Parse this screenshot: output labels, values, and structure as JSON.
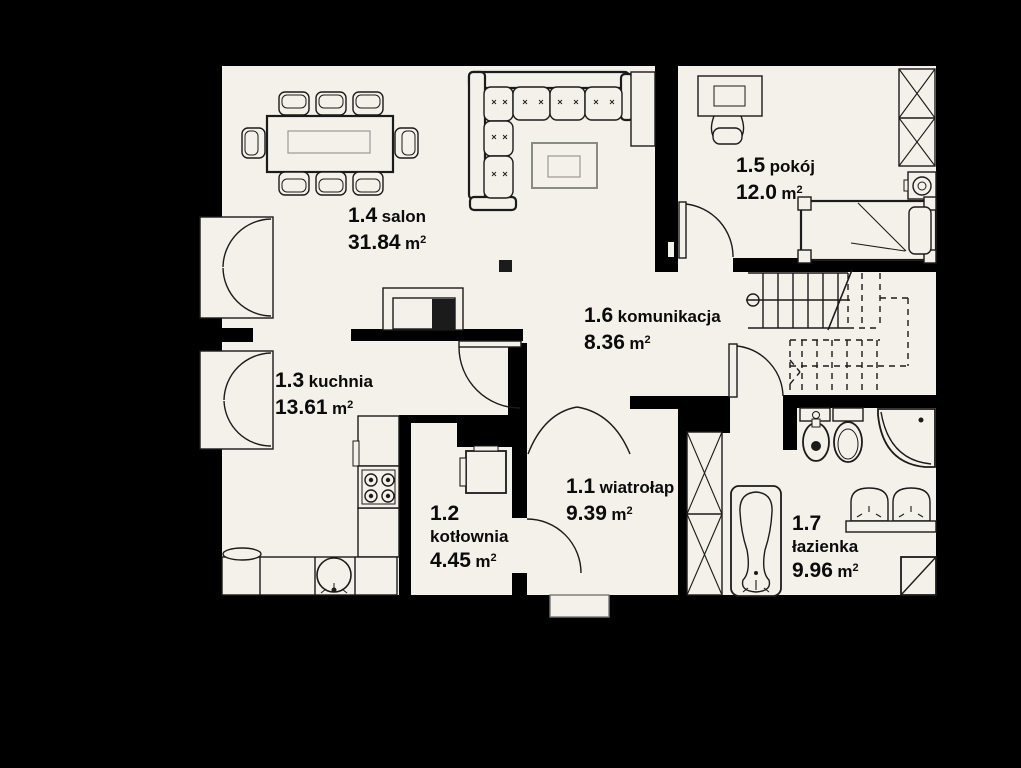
{
  "plan": {
    "unit": "m",
    "sup": "2",
    "rooms": [
      {
        "number": "1.1",
        "name": "wiatrołap",
        "area": "9.39"
      },
      {
        "number": "1.2",
        "name": "kotłownia",
        "area": "4.45"
      },
      {
        "number": "1.3",
        "name": "kuchnia",
        "area": "13.61"
      },
      {
        "number": "1.4",
        "name": "salon",
        "area": "31.84"
      },
      {
        "number": "1.5",
        "name": "pokój",
        "area": "12.0"
      },
      {
        "number": "1.6",
        "name": "komunikacja",
        "area": "8.36"
      },
      {
        "number": "1.7",
        "name": "łazienka",
        "area": "9.96"
      }
    ],
    "colors": {
      "background": "#000000",
      "wall": "#000000",
      "floor": "#f4f1ea",
      "line": "#1b1b1b",
      "furniture_gray": "#8a8a86"
    }
  }
}
